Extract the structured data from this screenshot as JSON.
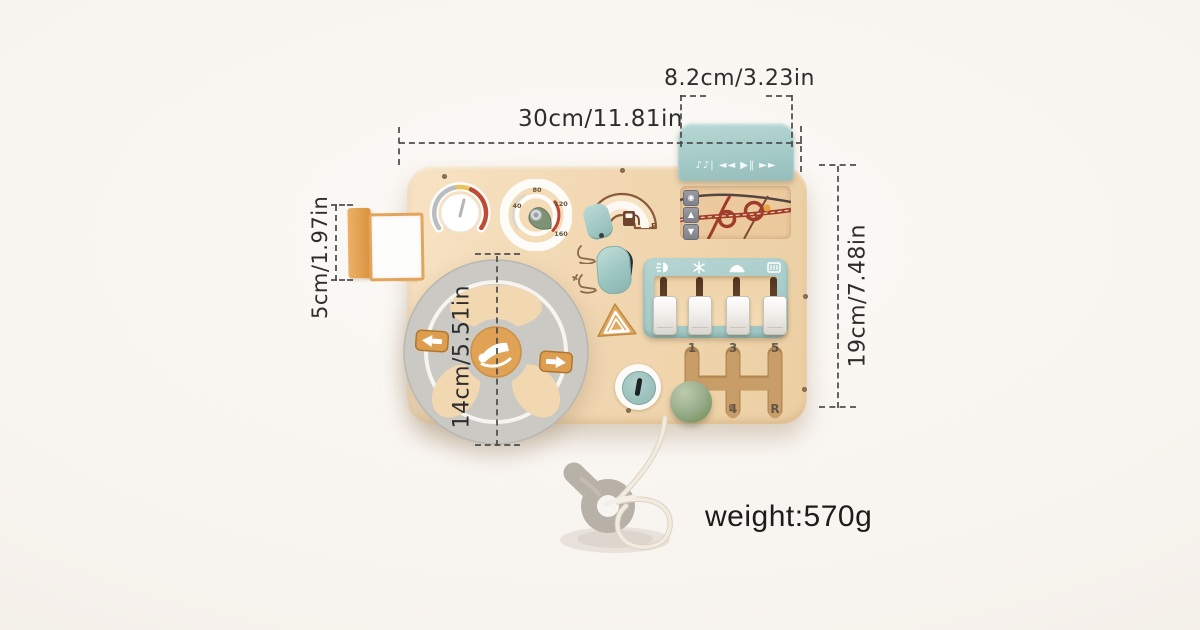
{
  "product": {
    "weight_label": "weight:570g"
  },
  "dimensions": {
    "radio_width": "8.2cm/3.23in",
    "board_width": "30cm/11.81in",
    "mirror_height": "5cm/1.97in",
    "steering_wheel_diameter": "14cm/5.51in",
    "board_height": "19cm/7.48in"
  },
  "board": {
    "radio_visor": {
      "media_glyphs": "♪♪|  ◄◄  ▶‖  ►►",
      "icon_names": [
        "music-notes-icon",
        "rewind-icon",
        "play-pause-icon",
        "fast-forward-icon"
      ]
    },
    "map_screen": {
      "buttons": [
        {
          "name": "location-pin-icon",
          "glyph": "◉"
        },
        {
          "name": "up-arrow-icon",
          "glyph": "▲"
        },
        {
          "name": "down-arrow-icon",
          "glyph": "▼"
        }
      ]
    },
    "speedometer": {
      "ticks": [
        "40",
        "80",
        "120",
        "160"
      ]
    },
    "fuel_gauge": {
      "full_label": "F"
    },
    "switch_panel": {
      "icon_names": [
        "headlight-icon",
        "snowflake-icon",
        "car-icon",
        "rear-defrost-icon"
      ]
    },
    "gear_shifter": {
      "labels": {
        "g1": "1",
        "g3": "3",
        "g5": "5",
        "g4": "4",
        "gr": "R"
      }
    }
  },
  "colors": {
    "board_wood": "#f2d9b4",
    "teal": "#a5cbc9",
    "orange": "#e0a255",
    "sage_green": "#8fa685",
    "rim_gray": "#cac9c4",
    "road_red": "#a23c2a",
    "annotation_text": "#2d2d2d"
  }
}
